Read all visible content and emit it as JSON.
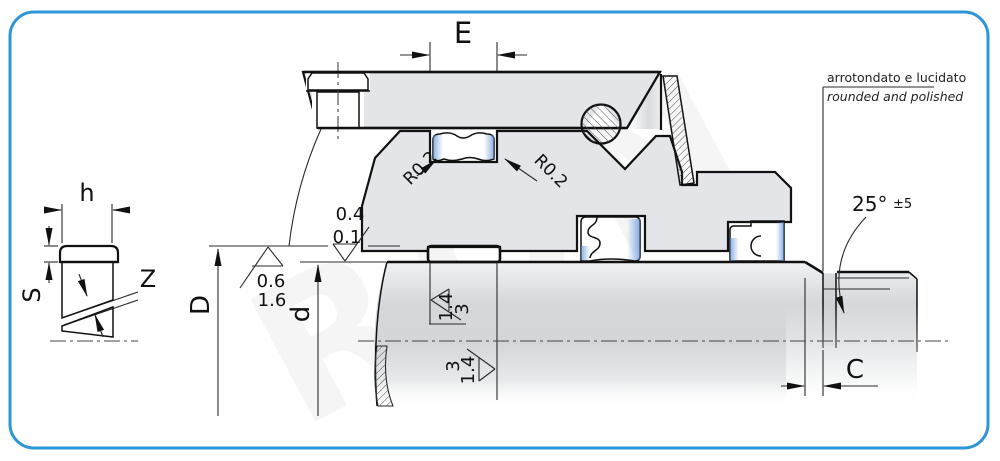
{
  "drawing": {
    "title_hint": "seal installation cross-section",
    "dims": {
      "E": "E",
      "h": "h",
      "S": "S",
      "Z": "Z",
      "D": "D",
      "d": "d",
      "C": "C"
    },
    "surface": {
      "groove_top": [
        "0.4",
        "0.1"
      ],
      "groove_bottom": [
        "0.6",
        "1.6"
      ],
      "shaft_top": [
        "1.4",
        "3"
      ],
      "shaft_bottom": [
        "3",
        "1.4"
      ]
    },
    "radius": {
      "left": "R0.2",
      "right": "R0.2"
    },
    "angle": {
      "value": "25°",
      "tol": "±5"
    },
    "note": {
      "it": "arrotondato e lucidato",
      "en": "rounded and polished"
    },
    "watermark": "RON",
    "colors": {
      "frame": "#2E96D6",
      "metal": "#e3e5e8",
      "seal_blue": "#4f86d0",
      "line": "#111111"
    }
  }
}
